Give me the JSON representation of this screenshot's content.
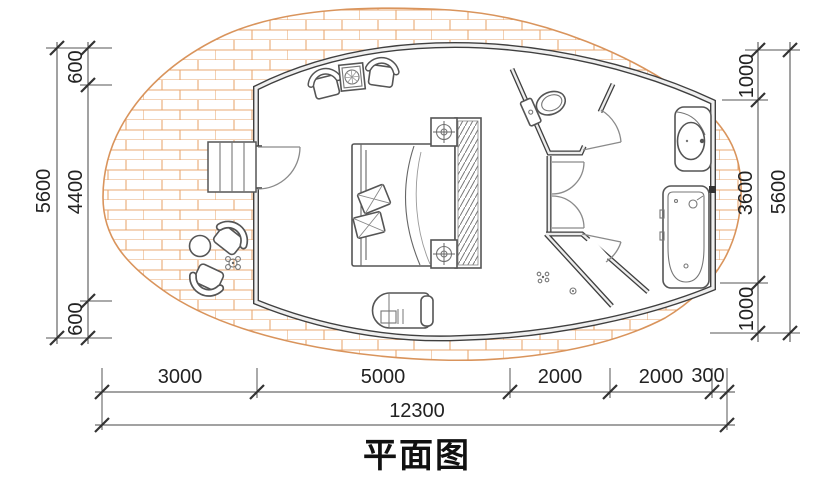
{
  "title": "平面图",
  "dimensions": {
    "left": {
      "overall": "5600",
      "segments": [
        "600",
        "4400",
        "600"
      ]
    },
    "right": {
      "overall": "5600",
      "segments": [
        "1000",
        "3600",
        "1000"
      ]
    },
    "bottom": {
      "overall": "12300",
      "segments": [
        "3000",
        "5000",
        "2000",
        "2000",
        "300"
      ]
    }
  },
  "colors": {
    "brick_hatch": "#e9a873",
    "deck_edge": "#d9945c",
    "wall_line": "#3f3f3f",
    "dimension_line": "#444444",
    "text": "#222222",
    "background": "#ffffff"
  },
  "icons": [
    "entry-stairs-icon",
    "entry-door-icon",
    "armchair-icon",
    "side-table-icon",
    "double-bed-icon",
    "pillow-icon",
    "wardrobe-hatch-icon",
    "downlight-cabinet-icon",
    "chaise-lounge-icon",
    "toilet-icon",
    "interior-door-icon",
    "shower-door-icon",
    "floor-drain-icon",
    "washbasin-icon",
    "bathtub-icon",
    "outdoor-armchair-icon",
    "outdoor-round-table-icon",
    "potted-plant-icon",
    "wood-deck-brick-hatch"
  ]
}
